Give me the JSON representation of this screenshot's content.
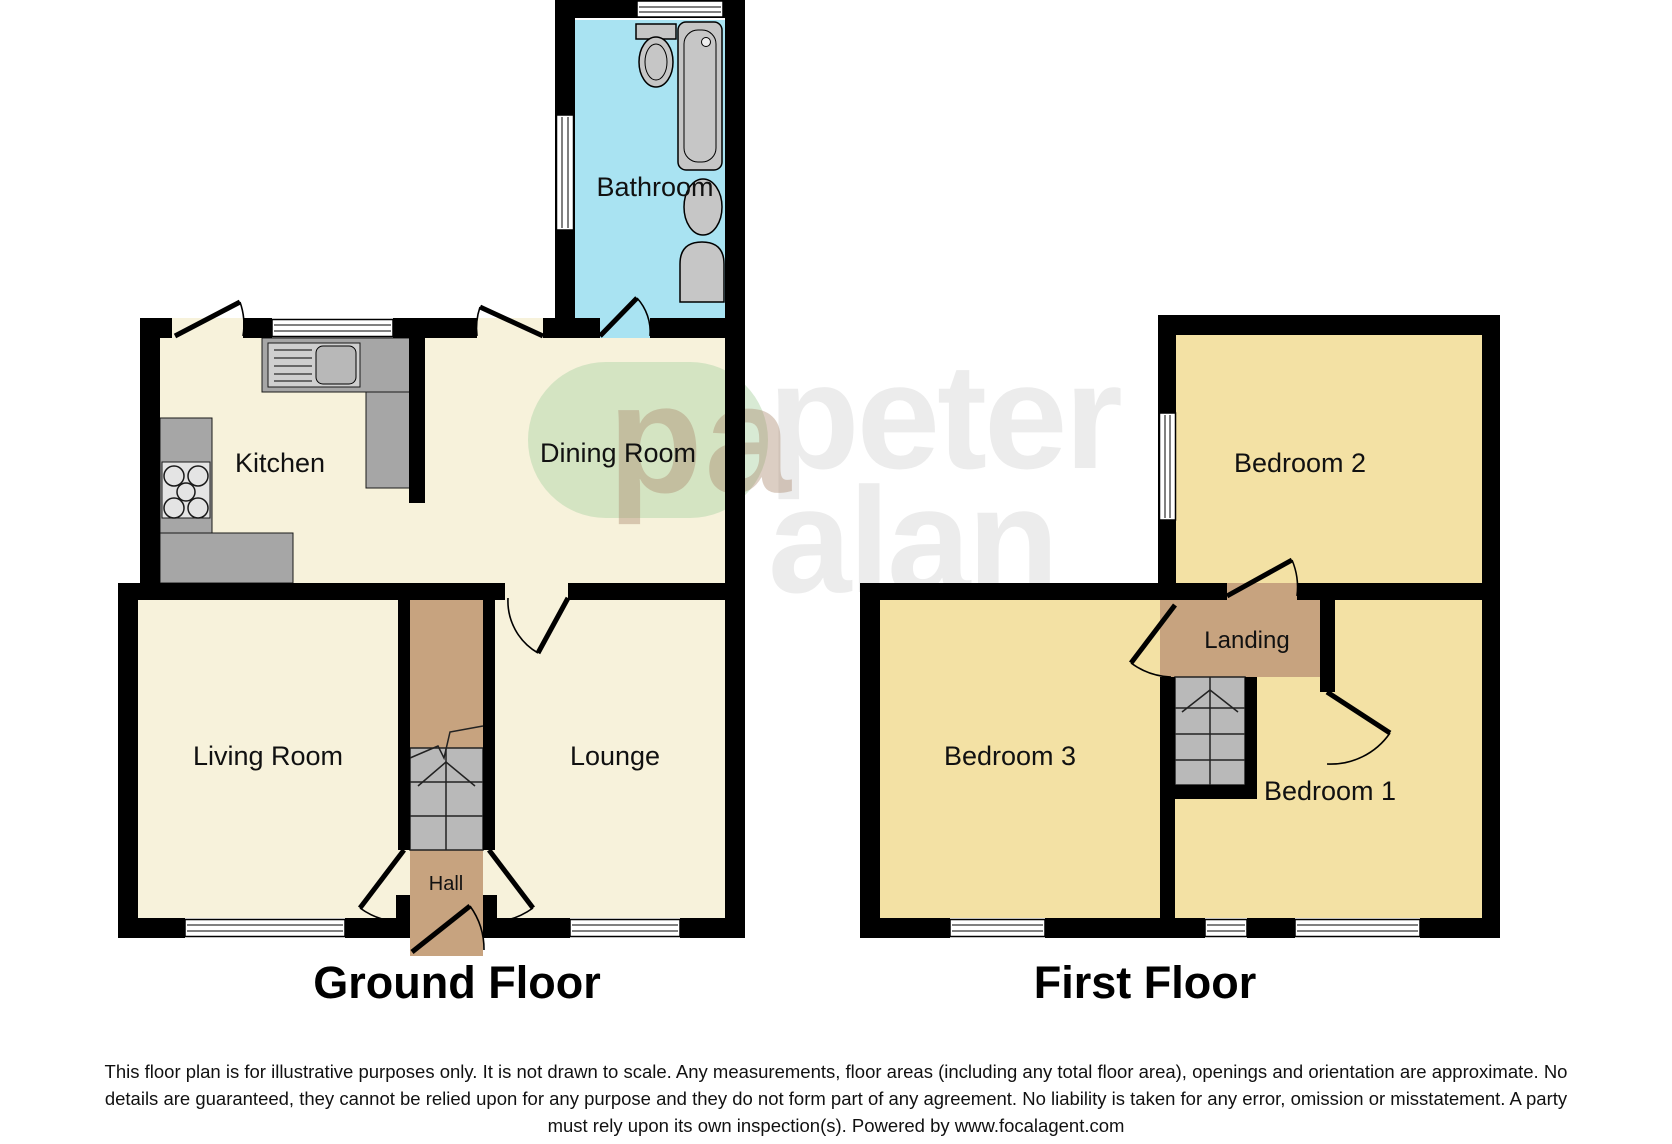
{
  "ground_floor": {
    "title": "Ground Floor",
    "rooms": {
      "bathroom": "Bathroom",
      "kitchen": "Kitchen",
      "dining_room": "Dining Room",
      "living_room": "Living Room",
      "lounge": "Lounge",
      "hall": "Hall"
    }
  },
  "first_floor": {
    "title": "First Floor",
    "rooms": {
      "bedroom_2": "Bedroom 2",
      "bedroom_3": "Bedroom 3",
      "bedroom_1": "Bedroom 1",
      "landing": "Landing"
    }
  },
  "watermark": {
    "logo": "pa",
    "brand_word_1": "peter",
    "brand_word_2": "alan"
  },
  "disclaimer": {
    "line1": "This floor plan is for illustrative purposes only. It is not drawn to scale. Any measurements, floor areas (including any total floor area), openings and orientation are approximate. No",
    "line2": "details are guaranteed, they cannot be relied upon for any purpose and they do not form part of any agreement. No liability is taken for any error, omission or misstatement. A party",
    "line3": "must rely upon its own inspection(s). Powered by www.focalagent.com"
  },
  "colors": {
    "ground_room_fill": "#f7f2db",
    "first_floor_fill": "#f3e1a4",
    "bathroom_fill": "#a9e3f2",
    "hall_landing_fill": "#c7a37f",
    "stairs_fill": "#b9b9b9",
    "counter_fill": "#a6a6a6",
    "wall": "#000000",
    "watermark_green": "#d4e8d0",
    "watermark_gray": "#ececec"
  }
}
